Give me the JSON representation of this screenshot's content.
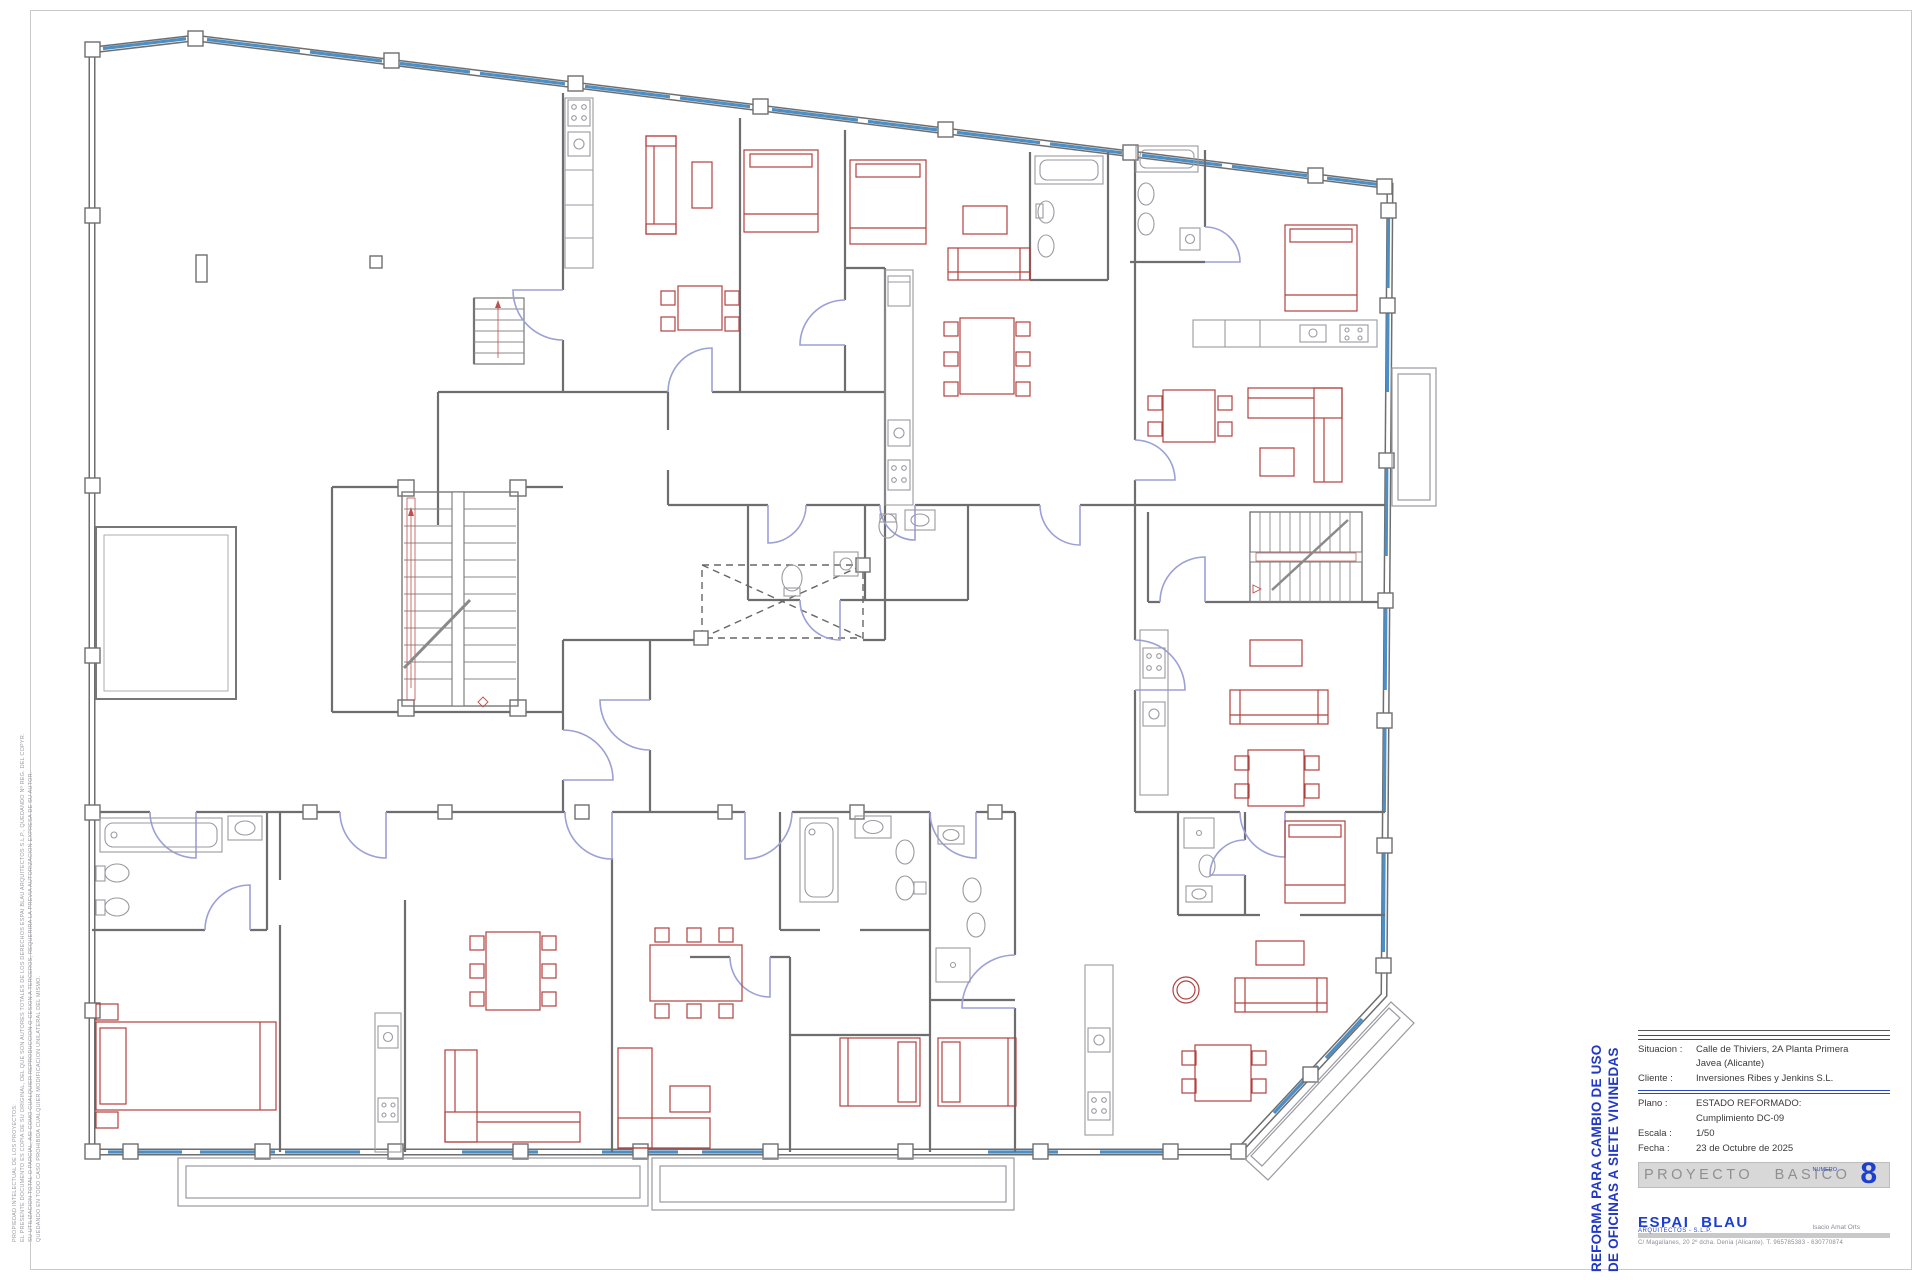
{
  "sheet": {
    "vertical_title": {
      "line1": "REFORMA PARA CAMBIO DE USO",
      "line2": "DE OFICINAS A SIETE VIVINEDAS"
    },
    "side_notes": {
      "line1": "PROPIEDAD INTELECTUAL DE LOS PROYECTOS:",
      "line2": "EL PRESENTE DOCUMENTO ES COPIA DE SU ORIGINAL, DEL QUE SON AUTORES TOTALES DE LOS DERECHOS ESPAI BLAU ARQUITECTOS S.L.P., QUEDANDO Nº REG. DEL COPYR.",
      "line3": "SU UTILIZACION TOTAL O PARCIAL, ASI COMO CUALQUIER REPRODUCCION O CESION A TERCEROS, REQUERIRA LA PREVIA AUTORIZACION EXPRESA DE SU AUTOR.",
      "line4": "QUEDANDO EN TODO CASO PROHIBIDA CUALQUIER MODIFICACION UNILATERAL DEL MISMO."
    },
    "title_block": {
      "situacion_label": "Situacion :",
      "situacion_value": "Calle de Thiviers, 2A Planta Primera",
      "situacion_value2": "Javea (Alicante)",
      "cliente_label": "Cliente :",
      "cliente_value": "Inversiones Ribes y Jenkins S.L.",
      "plano_label": "Plano :",
      "plano_value": "ESTADO REFORMADO:",
      "plano_value2": "Cumplimiento DC-09",
      "escala_label": "Escala :",
      "escala_value": "1/50",
      "fecha_label": "Fecha :",
      "fecha_value": "23 de Octubre de 2025",
      "project_bar_label": "PROYECTO BASICO",
      "numero_label": "NUMERO",
      "numero_value": "8"
    },
    "firm": {
      "name": "ESPAI BLAU",
      "subtitle": "ARQUITECTOS - S.L.P.",
      "architect": "Isacio Amat Orts",
      "address": "C/ Magallanes, 20 2º dcha. Denia (Alicante). T. 965785383 - 630770874"
    },
    "colors": {
      "wall": "#6e6e6e",
      "window": "#4c8fc6",
      "door": "#9ba0d6",
      "furniture": "#b0413e",
      "fixture": "#9a9aa0",
      "accent_blue": "#1d3fd0",
      "bar_gray": "#d8d8d8"
    }
  }
}
